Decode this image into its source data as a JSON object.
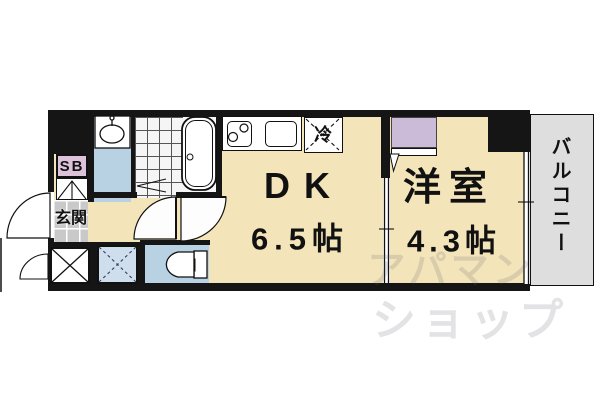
{
  "plan": {
    "dk": {
      "label": "DK",
      "size": "6.5帖"
    },
    "western_room": {
      "label": "洋室",
      "size": "4.3帖"
    },
    "balcony": {
      "label": "バルコニー"
    },
    "entrance": {
      "label": "玄関"
    },
    "shaft_box": {
      "label": "SB"
    },
    "refrigerator": {
      "label": "冷"
    },
    "watermark": {
      "line1": "アパマン",
      "line2": "ショップ"
    },
    "colors": {
      "floor": "#f3e4ba",
      "wet_area": "#b9d2e3",
      "closet": "#cbbad8",
      "sb_box": "#dcc3da",
      "balcony": "#dedede",
      "wall": "#151515",
      "entrance_tile": "#c9c9c9",
      "storage_blue": "#cfdeed"
    }
  }
}
